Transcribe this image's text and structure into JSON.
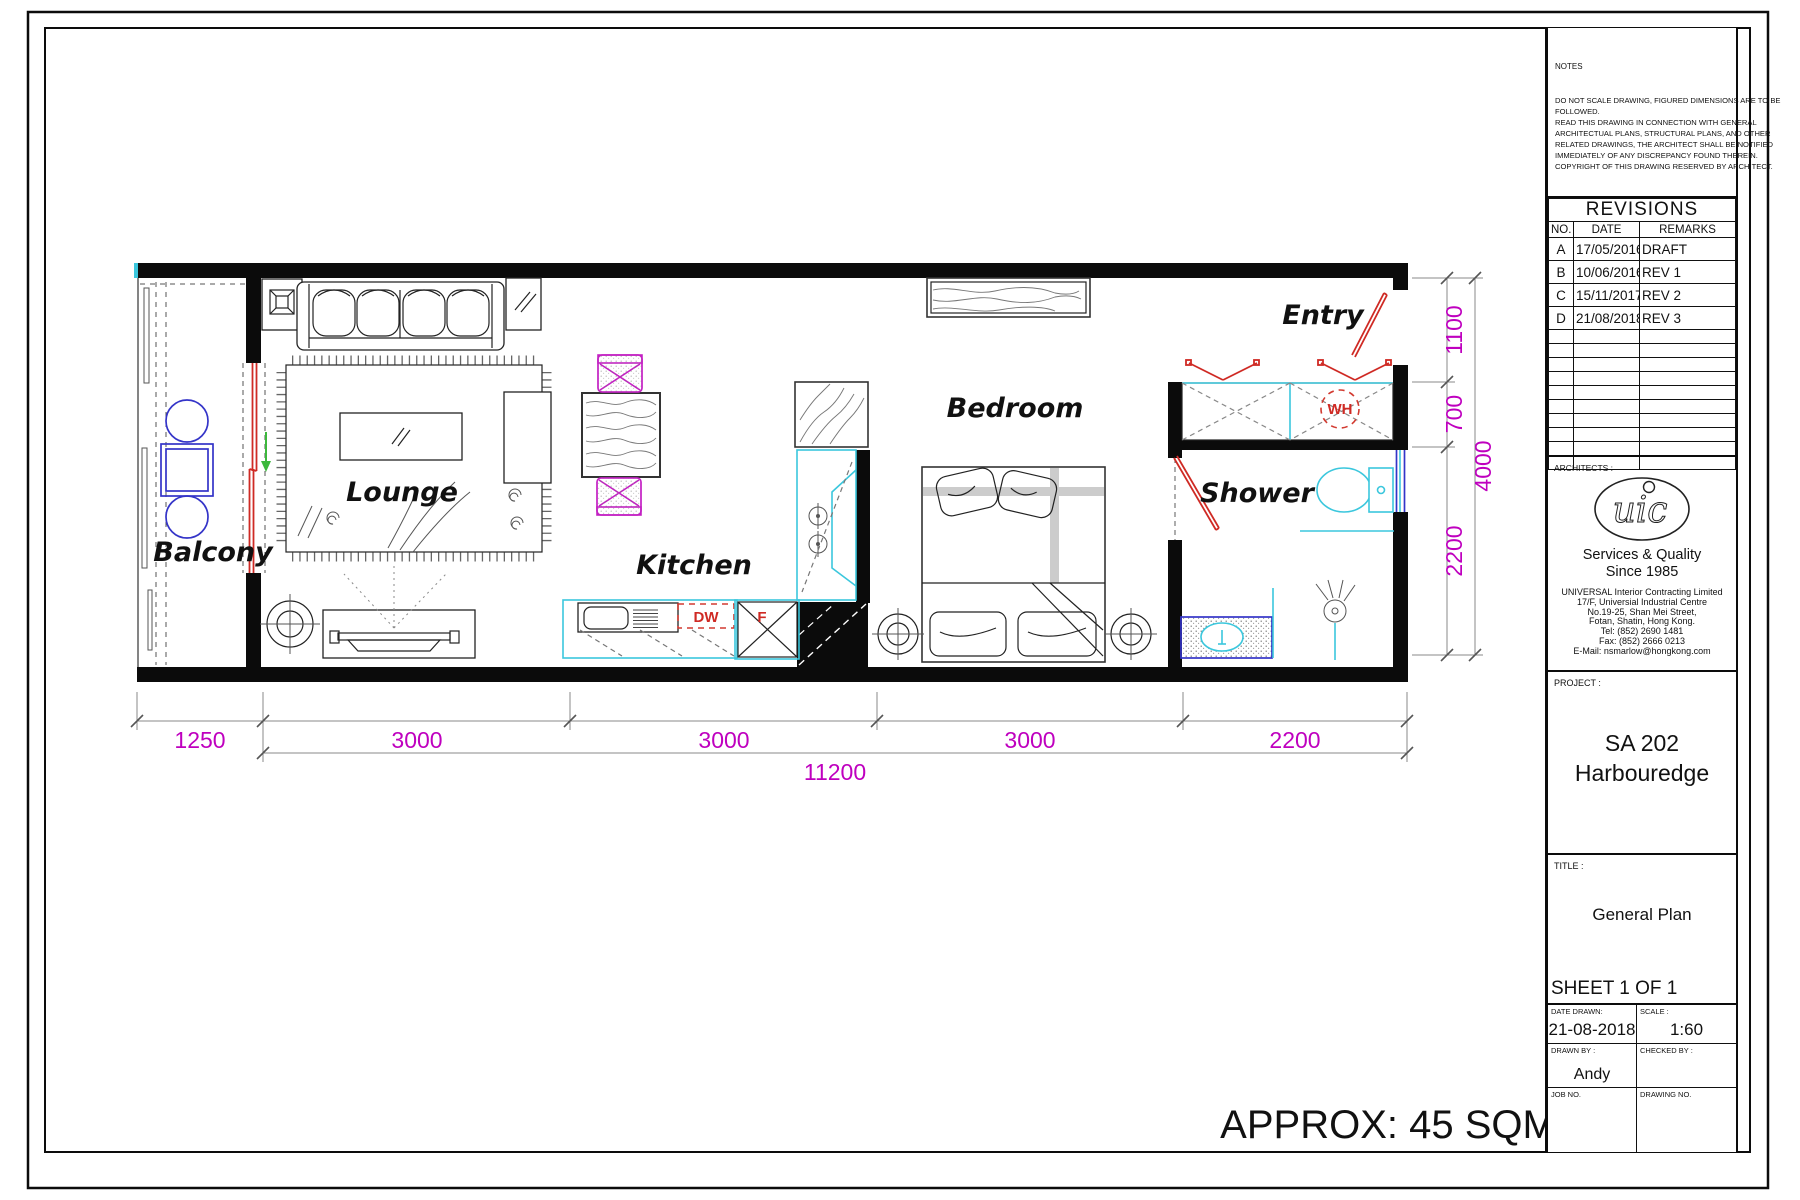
{
  "plan": {
    "labels": {
      "balcony": "Balcony",
      "lounge": "Lounge",
      "kitchen": "Kitchen",
      "bedroom": "Bedroom",
      "entry": "Entry",
      "shower": "Shower"
    },
    "appliances": {
      "dishwasher": "DW",
      "fridge": "F",
      "water_heater": "WH"
    },
    "area_note": "APPROX: 45 SQM",
    "dimensions": {
      "bottom_segments": [
        "1250",
        "3000",
        "3000",
        "3000",
        "2200"
      ],
      "bottom_total": "11200",
      "right_segments": [
        "1100",
        "700",
        "2200"
      ],
      "right_total": "4000"
    }
  },
  "title_block": {
    "notes": {
      "heading": "NOTES",
      "lines": [
        "DO NOT SCALE DRAWING, FIGURED DIMENSIONS ARE TO BE",
        "FOLLOWED.",
        "READ THIS DRAWING IN CONNECTION WITH GENERAL",
        "ARCHITECTUAL PLANS, STRUCTURAL PLANS, AND OTHER",
        "RELATED DRAWINGS, THE ARCHITECT SHALL BE NOTIFIED",
        "IMMEDIATELY OF ANY DISCREPANCY FOUND THEREIN.",
        "COPYRIGHT OF THIS DRAWING RESERVED BY ARCHITECT."
      ]
    },
    "revisions": {
      "title": "REVISIONS",
      "headers": [
        "NO.",
        "DATE",
        "REMARKS"
      ],
      "rows": [
        [
          "A",
          "17/05/2016",
          "DRAFT"
        ],
        [
          "B",
          "10/06/2016",
          "REV 1"
        ],
        [
          "C",
          "15/11/2017",
          "REV 2"
        ],
        [
          "D",
          "21/08/2018",
          "REV 3"
        ]
      ]
    },
    "architects": {
      "label": "ARCHITECTS :",
      "logo_text": "uic",
      "tagline1": "Services & Quality",
      "tagline2": "Since 1985",
      "address_lines": [
        "UNIVERSAL Interior Contracting Limited",
        "17/F, Universial Industrial Centre",
        "No.19-25, Shan Mei Street,",
        "Fotan, Shatin, Hong Kong.",
        "Tel: (852) 2690 1481",
        "Fax: (852) 2666 0213",
        "E-Mail: nsmarlow@hongkong.com"
      ]
    },
    "project": {
      "label": "PROJECT :",
      "name_line1": "SA 202",
      "name_line2": "Harbouredge"
    },
    "title": {
      "label": "TITLE :",
      "value": "General Plan"
    },
    "sheet": "SHEET 1 OF 1",
    "fields": {
      "date_drawn_label": "DATE DRAWN:",
      "date_drawn": "21-08-2018",
      "scale_label": "SCALE :",
      "scale": "1:60",
      "drawn_by_label": "DRAWN BY :",
      "drawn_by": "Andy",
      "checked_by_label": "CHECKED BY :",
      "job_no_label": "JOB NO.",
      "drawing_no_label": "DRAWING NO."
    }
  },
  "colors": {
    "dimension": "#bf00bf",
    "door_red": "#cf2a24",
    "fixture_cyan": "#3bc7dd",
    "furniture_blue": "#3434c8",
    "wall_black": "#0b0b0b",
    "arrow_green": "#3cb83c"
  }
}
